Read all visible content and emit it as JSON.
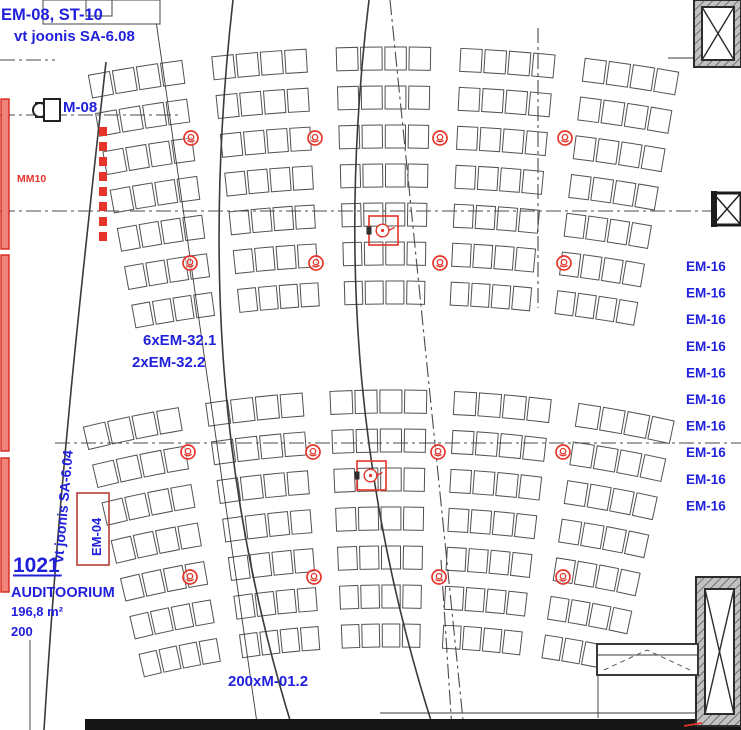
{
  "meta": {
    "document_type": "architectural-electrical-plan",
    "room": {
      "number": "1021",
      "name": "AUDITOORIUM",
      "area": "196,8 m²",
      "capacity": "200"
    }
  },
  "colors": {
    "blue": "#2121dc",
    "red": "#e5352b",
    "red_fill": "#f0837a",
    "line": "#3a3a3a",
    "seat": "#515151",
    "wall": "#161616",
    "dashdot": "#4a4a4a"
  },
  "labels": [
    {
      "name": "label-em08-st10",
      "text": "EM-08, ST-10",
      "x": 1,
      "y": 20,
      "size": 16.5,
      "color": "blue",
      "weight": 700
    },
    {
      "name": "label-vt-joonis-sa608",
      "text": "vt joonis SA-6.08",
      "x": 14,
      "y": 41,
      "size": 15,
      "color": "blue",
      "weight": 700
    },
    {
      "name": "label-m08",
      "text": "M-08",
      "x": 63,
      "y": 112,
      "size": 15,
      "color": "blue",
      "weight": 700
    },
    {
      "name": "label-mm10",
      "text": "MM10",
      "x": 17,
      "y": 182,
      "size": 10.5,
      "color": "red",
      "weight": 700
    },
    {
      "name": "label-6xem-32-1",
      "text": "6xEM-32.1",
      "x": 143,
      "y": 345,
      "size": 15,
      "color": "blue",
      "weight": 700
    },
    {
      "name": "label-2xem-32-2",
      "text": "2xEM-32.2",
      "x": 132,
      "y": 367,
      "size": 15,
      "color": "blue",
      "weight": 700
    },
    {
      "name": "label-room-number",
      "text": "1021",
      "x": 13,
      "y": 572,
      "size": 21,
      "color": "blue",
      "weight": 700,
      "underline": true
    },
    {
      "name": "label-room-name",
      "text": "AUDITOORIUM",
      "x": 11,
      "y": 597,
      "size": 14.5,
      "color": "blue",
      "weight": 700
    },
    {
      "name": "label-room-area",
      "text": "196,8 m²",
      "x": 11,
      "y": 616,
      "size": 13,
      "color": "blue",
      "weight": 700
    },
    {
      "name": "label-room-capacity",
      "text": "200",
      "x": 11,
      "y": 636,
      "size": 13,
      "color": "blue",
      "weight": 700
    },
    {
      "name": "label-200xm-01-2",
      "text": "200xM-01.2",
      "x": 228,
      "y": 686,
      "size": 15,
      "color": "blue",
      "weight": 700
    },
    {
      "name": "label-em04",
      "text": "EM-04",
      "x": 0,
      "y": 0,
      "size": 13,
      "color": "blue",
      "weight": 700,
      "transform": "translate(101,556) rotate(-90)"
    },
    {
      "name": "label-vt-joonis-sa604",
      "text": "vt joonis SA-6.04",
      "x": 0,
      "y": 0,
      "size": 14,
      "color": "blue",
      "weight": 700,
      "transform": "translate(63,563) rotate(-85)"
    }
  ],
  "em16_stack": {
    "text": "EM-16",
    "x": 686,
    "y_start": 271,
    "y_step": 26.6,
    "count": 10,
    "size": 13.5,
    "color": "blue",
    "weight": 700
  },
  "drawing": {
    "width": 741,
    "height": 730,
    "seat_banks": [
      {
        "cx": 392,
        "cy": 1690,
        "r0": 1645,
        "row_step": 39,
        "rows": 7,
        "theta_start": -10.7,
        "theta_end": 10.1,
        "sections": 5,
        "seats_per_section": 4,
        "gap_deg": 0.95,
        "depth": 27
      },
      {
        "cx": 392,
        "cy": 1690,
        "r0": 1302,
        "row_step": 39,
        "rows": 7,
        "theta_start": -13.8,
        "theta_end": 12.6,
        "sections": 5,
        "seats_per_section": 4,
        "gap_deg": 1.1,
        "depth": 27
      }
    ],
    "curves": [
      "M233,0 C207,230 212,470 293,730",
      "M369,0 C341,230 350,470 434,730",
      "M106,62 C84,260 60,470 44,730"
    ],
    "thin_lines": [
      [
        153,
        0,
        258,
        730
      ],
      [
        30,
        640,
        30,
        730
      ],
      [
        668,
        58,
        694,
        58
      ],
      [
        380,
        713,
        741,
        713
      ],
      [
        598,
        675,
        598,
        718
      ]
    ],
    "dashdot_lines": [
      [
        0,
        60,
        55,
        60
      ],
      [
        0,
        115,
        178,
        115
      ],
      [
        0,
        211,
        741,
        211
      ],
      [
        55,
        443,
        741,
        443
      ],
      [
        538,
        28,
        538,
        308
      ],
      [
        390,
        0,
        464,
        730
      ],
      [
        441,
        560,
        452,
        730
      ]
    ],
    "walls": [
      [
        85,
        719,
        656,
        11
      ]
    ],
    "top_boxes": [
      [
        43,
        0,
        117,
        24
      ],
      [
        86,
        0,
        26,
        16
      ]
    ],
    "shafts": [
      {
        "outer": [
          694,
          0,
          47,
          67
        ],
        "inner": [
          702,
          7,
          32,
          53
        ]
      },
      {
        "outer": [
          696,
          577,
          45,
          149
        ],
        "inner": [
          705,
          589,
          29,
          125
        ]
      }
    ],
    "xbox": {
      "rect": [
        713,
        193,
        28,
        32
      ]
    },
    "door": {
      "rect": [
        597,
        644,
        101,
        31
      ],
      "mid_y": 655,
      "chevron": [
        [
          604,
          670
        ],
        [
          647,
          650
        ],
        [
          690,
          670
        ]
      ]
    },
    "red_bars": [
      [
        1,
        99,
        8,
        150
      ],
      [
        1,
        255,
        8,
        196
      ],
      [
        1,
        458,
        8,
        134
      ]
    ],
    "red_dash_bar": {
      "x": 99,
      "y": 127,
      "w": 8,
      "h": 114,
      "block": 9,
      "gap": 6
    },
    "em04_box": [
      77,
      493,
      32,
      72
    ],
    "m08_symbol": {
      "x": 44,
      "y": 99,
      "w": 16,
      "h": 22
    },
    "speakers": [
      [
        191,
        138
      ],
      [
        315,
        138
      ],
      [
        440,
        138
      ],
      [
        565,
        138
      ],
      [
        190,
        263
      ],
      [
        316,
        263
      ],
      [
        440,
        263
      ],
      [
        564,
        263
      ],
      [
        188,
        452
      ],
      [
        313,
        452
      ],
      [
        438,
        452
      ],
      [
        563,
        452
      ],
      [
        190,
        577
      ],
      [
        314,
        577
      ],
      [
        439,
        577
      ],
      [
        563,
        577
      ]
    ],
    "red_squares": [
      [
        369,
        216,
        29
      ],
      [
        357,
        461,
        29
      ]
    ],
    "red_corner": [
      684,
      726,
      702,
      723
    ]
  }
}
